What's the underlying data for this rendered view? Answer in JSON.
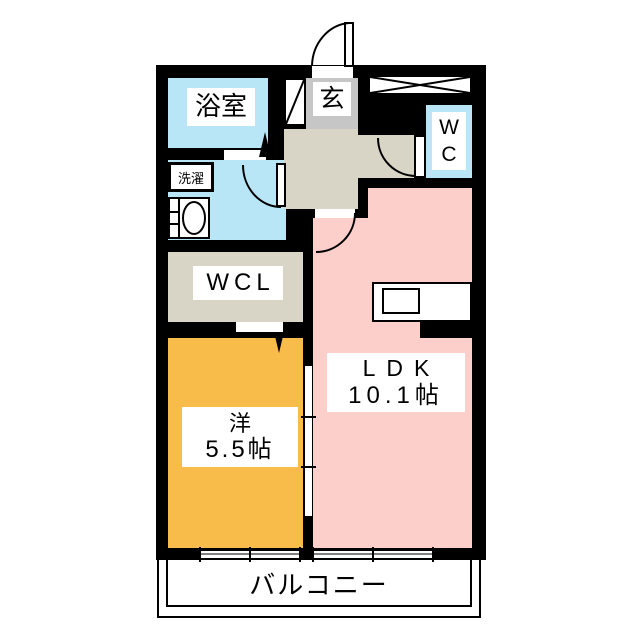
{
  "plan": {
    "rooms": {
      "bath": {
        "label": "浴室"
      },
      "washroom": {
        "laundry": "洗濯"
      },
      "wcl": {
        "label": "WCL"
      },
      "genkan": {
        "label": "玄"
      },
      "wc": {
        "letters": [
          "W",
          "C"
        ]
      },
      "western": {
        "name": "洋",
        "size": "5.5帖"
      },
      "ldk": {
        "name": "LDK",
        "size": "10.1帖"
      },
      "balcony": {
        "label": "バルコニー"
      }
    },
    "colors": {
      "wall": "#000000",
      "water": "#b9e6f7",
      "hallway": "#d8d4c6",
      "genkan": "#c6c6c6",
      "western": "#f7bc4a",
      "ldk": "#fccfcb"
    }
  }
}
